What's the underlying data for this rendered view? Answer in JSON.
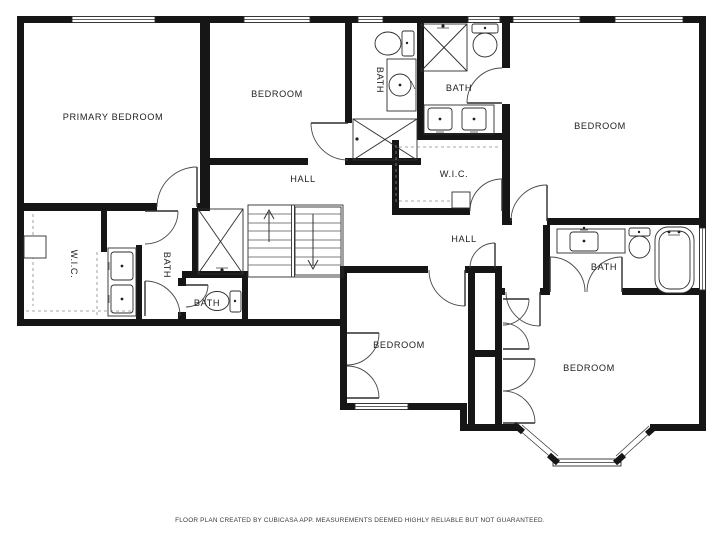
{
  "labels": {
    "primary_bedroom": "PRIMARY BEDROOM",
    "bedroom_top_middle": "BEDROOM",
    "bedroom_top_right": "BEDROOM",
    "bedroom_bottom_center": "BEDROOM",
    "bedroom_bottom_right": "BEDROOM",
    "bath_top_left": "BATH",
    "bath_top_right": "BATH",
    "bath_left": "BATH",
    "bath_small": "BATH",
    "bath_right": "BATH",
    "wic_left": "W.I.C.",
    "wic_top": "W.I.C.",
    "hall_upper": "HALL",
    "hall_lower": "HALL"
  },
  "footer": {
    "disclaimer": "FLOOR PLAN CREATED BY CUBICASA APP. MEASUREMENTS DEEMED HIGHLY RELIABLE BUT NOT GUARANTEED."
  },
  "colors": {
    "wall": "#161616",
    "line": "#2e2e2e",
    "door_arc": "#4a4a4a",
    "background": "#ffffff",
    "label": "#222222"
  },
  "fixtures": [
    "shower",
    "toilet",
    "sink",
    "double-vanity",
    "bathtub",
    "stairs",
    "closet-bifold",
    "bay-window"
  ]
}
